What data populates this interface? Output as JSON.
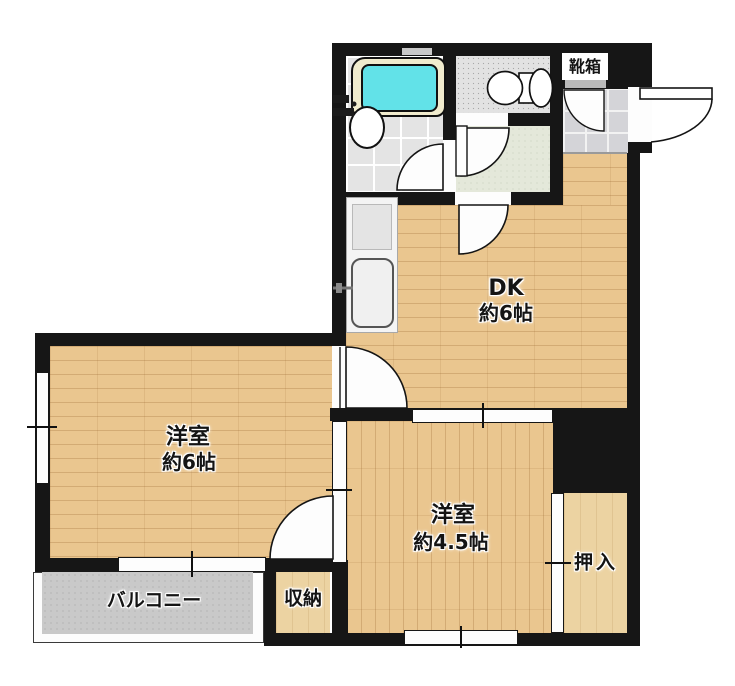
{
  "title": "間取り図",
  "colors": {
    "wall": "#161616",
    "wood": "#eac68f",
    "wood_light": "#ecd3a2",
    "tub_rim": "#f1ecce",
    "bath_water": "#62e2e8",
    "tile_gray": "#e4e4e4",
    "toilet_floor": "#e2e2e2",
    "hall_floor": "#e4e8da",
    "marble": "#d4d4d8",
    "balcony_floor": "#c9c9c9"
  },
  "rooms": {
    "dk": {
      "name": "DK",
      "size": "約6帖"
    },
    "western6": {
      "name": "洋室",
      "size": "約6帖"
    },
    "western45": {
      "name": "洋室",
      "size": "約4.5帖"
    },
    "closet": {
      "label": "押入"
    },
    "storage": {
      "label": "収納"
    },
    "balcony": {
      "label": "バルコニー"
    },
    "shoebox": {
      "label": "靴箱"
    }
  }
}
